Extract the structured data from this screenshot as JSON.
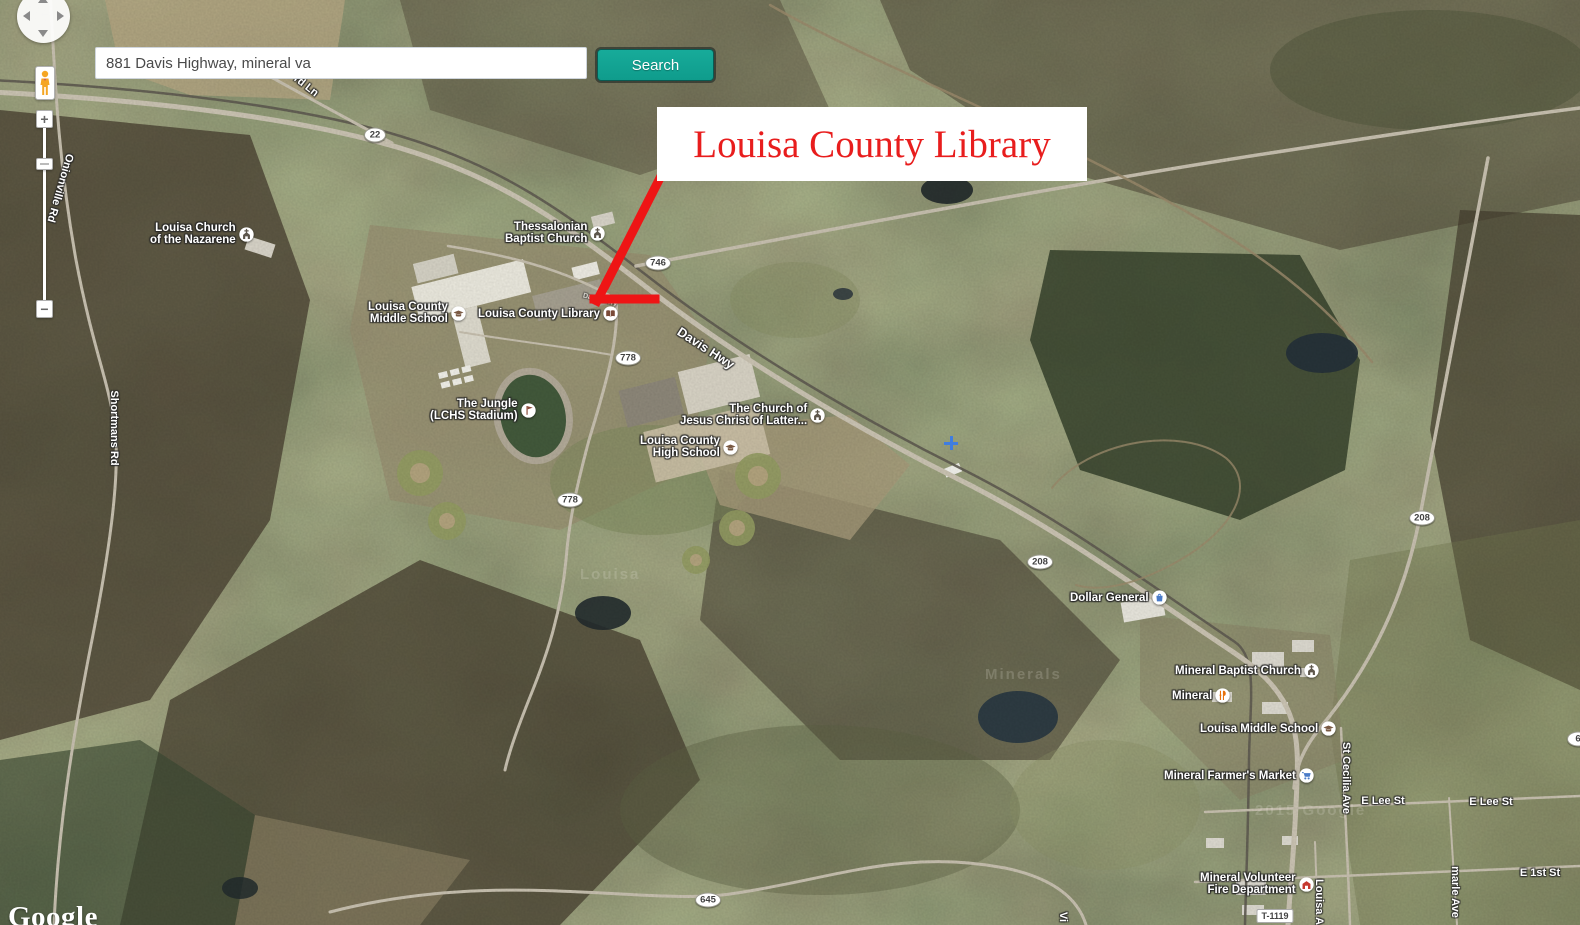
{
  "search": {
    "query": "881 Davis Highway, mineral va",
    "button_label": "Search"
  },
  "annotation": {
    "title": "Louisa County Library",
    "color": "#e81d1d",
    "arrow_color": "#ee1515"
  },
  "controls": {
    "zoom_in": "+",
    "zoom_out": "−"
  },
  "logo": "Google",
  "map": {
    "labels": [
      {
        "id": "label-louisa-church-nazarene",
        "lines": [
          "Louisa Church",
          "of the Nazarene"
        ],
        "icon": "church-icon",
        "x": 150,
        "y": 222
      },
      {
        "id": "label-thessalonian-baptist-church",
        "lines": [
          "Thessalonian",
          "Baptist Church"
        ],
        "icon": "church-icon",
        "x": 505,
        "y": 221
      },
      {
        "id": "label-louisa-county-middle-school",
        "lines": [
          "Louisa County",
          "Middle School"
        ],
        "icon": "school-icon",
        "x": 368,
        "y": 301
      },
      {
        "id": "label-louisa-county-library",
        "lines": [
          "Louisa County Library"
        ],
        "icon": "library-icon",
        "x": 478,
        "y": 306
      },
      {
        "id": "label-the-jungle-lchs-stadium",
        "lines": [
          "The Jungle",
          "(LCHS Stadium)"
        ],
        "icon": "stadium-icon",
        "x": 430,
        "y": 398
      },
      {
        "id": "label-church-of-jesus-christ",
        "lines": [
          "The Church of",
          "Jesus Christ of Latter..."
        ],
        "icon": "church-icon",
        "x": 680,
        "y": 403
      },
      {
        "id": "label-louisa-county-high-school",
        "lines": [
          "Louisa County",
          "High School"
        ],
        "icon": "school-icon",
        "x": 640,
        "y": 435
      },
      {
        "id": "label-dollar-general",
        "lines": [
          "Dollar General"
        ],
        "icon": "shopping-icon",
        "x": 1070,
        "y": 590
      },
      {
        "id": "label-mineral-baptist-church",
        "lines": [
          "Mineral Baptist Church"
        ],
        "icon": "church-icon",
        "x": 1175,
        "y": 663
      },
      {
        "id": "label-mineral-restaurant",
        "lines": [
          "Mineral"
        ],
        "icon": "restaurant-icon",
        "x": 1172,
        "y": 688
      },
      {
        "id": "label-louisa-middle-school",
        "lines": [
          "Louisa Middle School"
        ],
        "icon": "school-icon",
        "x": 1200,
        "y": 721
      },
      {
        "id": "label-mineral-farmers-market",
        "lines": [
          "Mineral Farmer's Market"
        ],
        "icon": "cart-icon",
        "x": 1164,
        "y": 768
      },
      {
        "id": "label-mineral-volunteer-fire-department",
        "lines": [
          "Mineral Volunteer",
          "Fire Department"
        ],
        "icon": "fire-icon",
        "x": 1200,
        "y": 872
      }
    ],
    "road_labels": [
      {
        "text": "rd Ln",
        "x": 306,
        "y": 86,
        "rot": 38,
        "size": 11,
        "opacity": 1
      },
      {
        "text": "Davis Hwy",
        "x": 706,
        "y": 348,
        "rot": 33,
        "size": 13,
        "opacity": 1
      },
      {
        "text": "Davis Hwy",
        "x": 600,
        "y": 300,
        "rot": 14,
        "size": 7,
        "opacity": 0.55
      },
      {
        "text": "Onionville Rd",
        "x": 60,
        "y": 188,
        "rot": 106,
        "size": 11,
        "opacity": 1
      },
      {
        "text": "Shortmans Rd",
        "x": 114,
        "y": 428,
        "rot": 90,
        "size": 11,
        "opacity": 1
      },
      {
        "text": "St Cecilia Ave",
        "x": 1346,
        "y": 778,
        "rot": 90,
        "size": 11,
        "opacity": 1
      },
      {
        "text": "Louisa A",
        "x": 1319,
        "y": 902,
        "rot": 90,
        "size": 11,
        "opacity": 1
      },
      {
        "text": "marle Ave",
        "x": 1455,
        "y": 892,
        "rot": 90,
        "size": 11,
        "opacity": 1
      },
      {
        "text": "Vi",
        "x": 1063,
        "y": 917,
        "rot": 90,
        "size": 11,
        "opacity": 1
      },
      {
        "text": "E Lee St",
        "x": 1383,
        "y": 801,
        "rot": 0,
        "size": 11,
        "opacity": 1
      },
      {
        "text": "E Lee St",
        "x": 1491,
        "y": 802,
        "rot": 0,
        "size": 11,
        "opacity": 1
      },
      {
        "text": "E 1st St",
        "x": 1540,
        "y": 873,
        "rot": 0,
        "size": 11,
        "opacity": 1
      }
    ],
    "route_shields": [
      {
        "num": "22",
        "x": 375,
        "y": 135
      },
      {
        "num": "746",
        "x": 658,
        "y": 263
      },
      {
        "num": "778",
        "x": 628,
        "y": 358
      },
      {
        "num": "778",
        "x": 570,
        "y": 500
      },
      {
        "num": "208",
        "x": 1040,
        "y": 562
      },
      {
        "num": "208",
        "x": 1422,
        "y": 518
      },
      {
        "num": "645",
        "x": 708,
        "y": 900
      },
      {
        "num": "6",
        "x": 1578,
        "y": 739
      }
    ],
    "box_labels": [
      {
        "text": "T-1119",
        "x": 1275,
        "y": 916
      }
    ],
    "markers": [
      {
        "type": "blue-cross",
        "x": 951,
        "y": 443
      }
    ],
    "watermarks": [
      {
        "text": "Louisa",
        "x": 580,
        "y": 566
      },
      {
        "text": "Minerals",
        "x": 985,
        "y": 666
      },
      {
        "text": "2015 Google",
        "x": 1255,
        "y": 802
      }
    ]
  }
}
